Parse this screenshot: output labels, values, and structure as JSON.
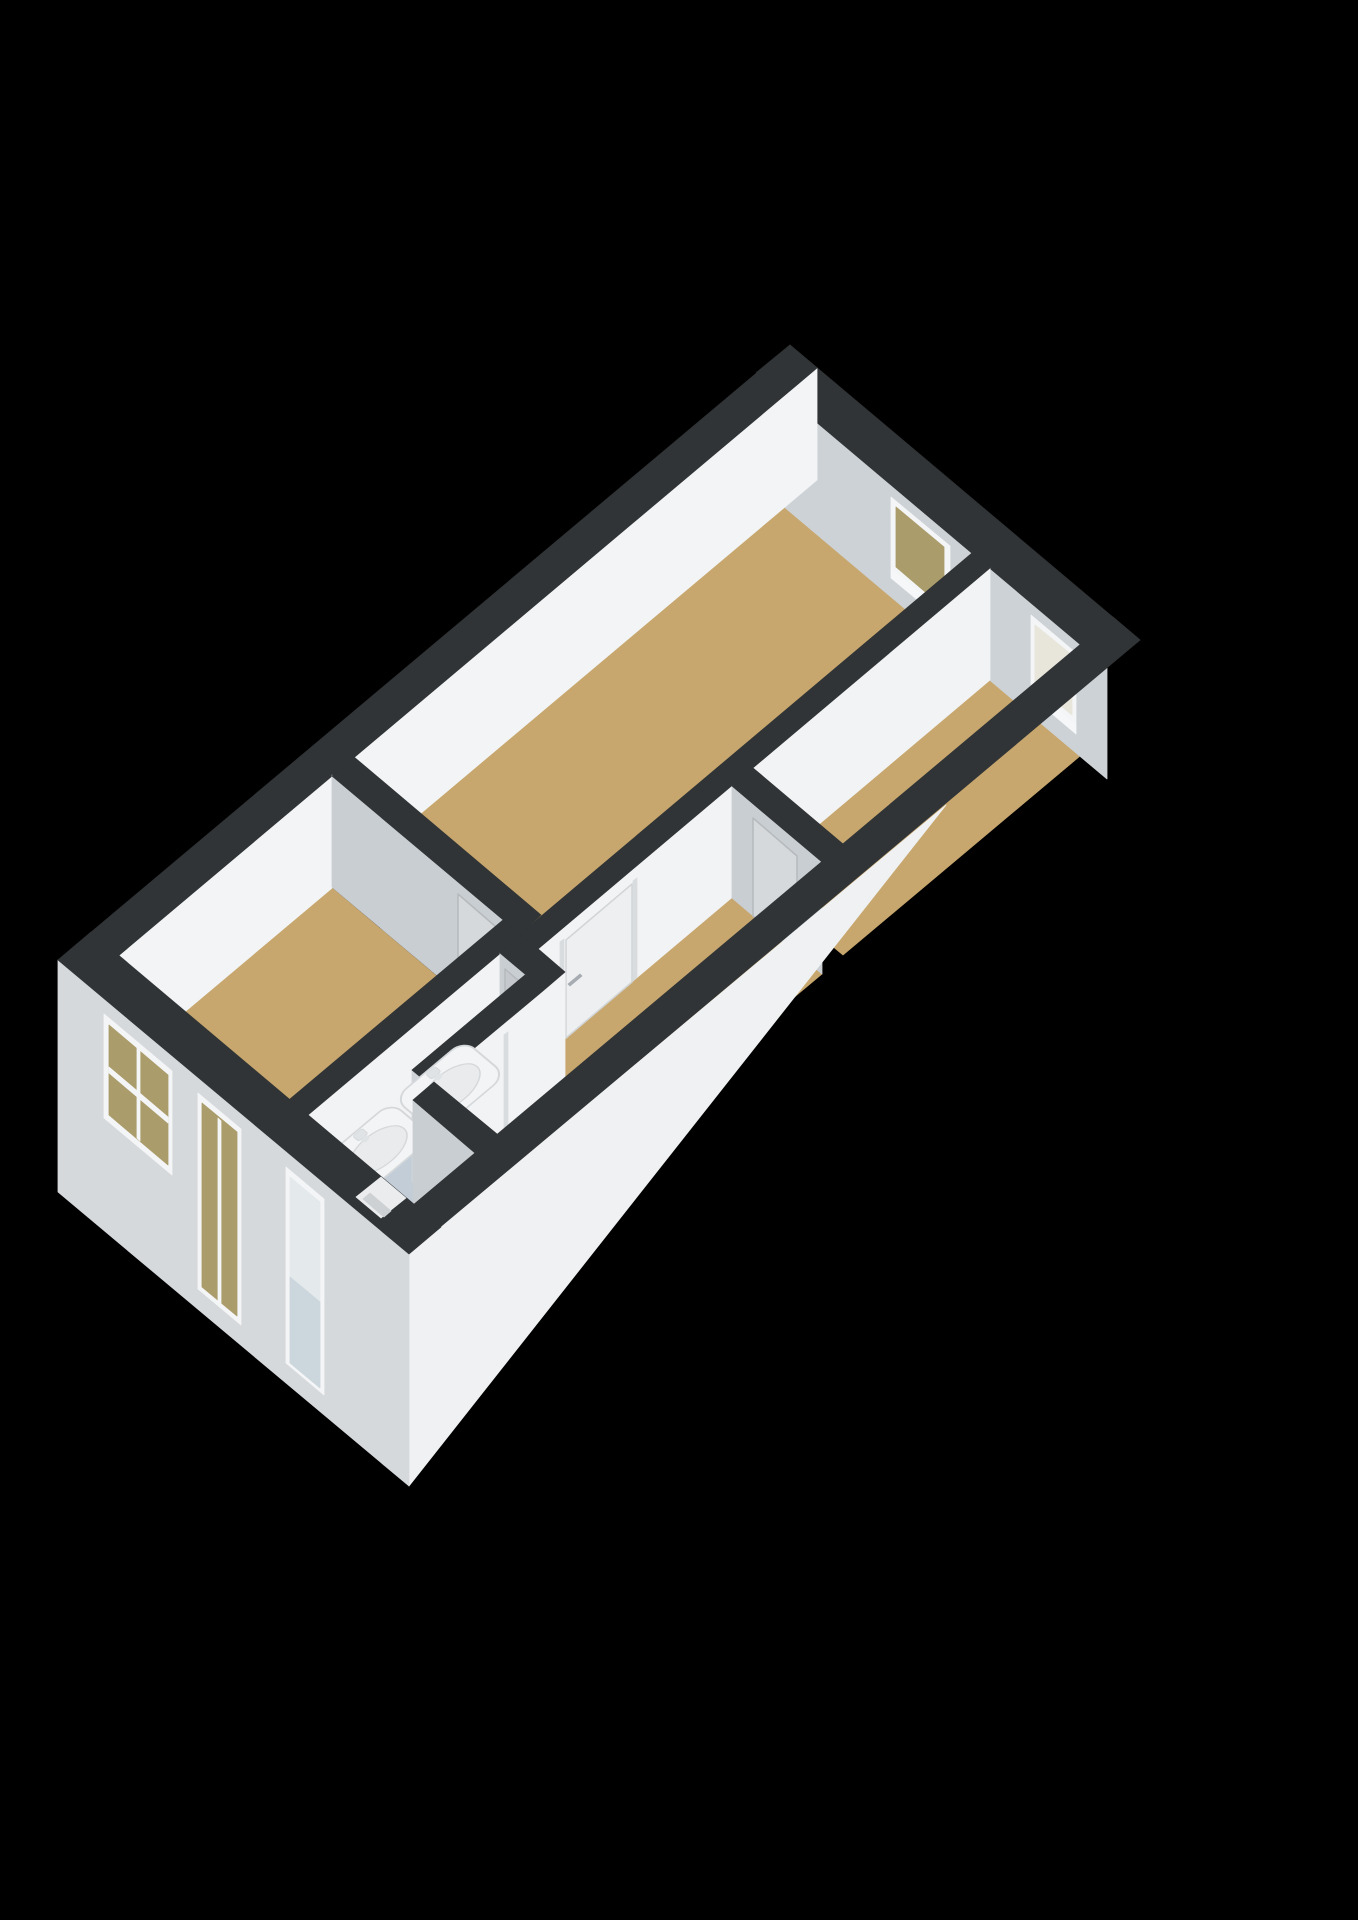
{
  "meta": {
    "title": "3D axonometric floor plan render",
    "background": "#000000",
    "style": "dark wall tops, white walls, wood floors, black background"
  },
  "summary": {
    "rooms": [
      {
        "name": "bedroom-top",
        "floor": "wood-tan"
      },
      {
        "name": "bedroom-right",
        "floor": "wood-tan",
        "features": [
          "window"
        ]
      },
      {
        "name": "bedroom-left",
        "floor": "wood-tan",
        "features": [
          "facade-window",
          "facade-tall-window"
        ]
      },
      {
        "name": "hallway",
        "floor": "wood-tan",
        "features": [
          "doors-to-rooms"
        ]
      },
      {
        "name": "stair-nook",
        "floor": "wood-tan",
        "features": [
          "step-block"
        ]
      },
      {
        "name": "bathroom",
        "floor": "blue-gray",
        "features": [
          "double-washbasin",
          "gray-door",
          "facade-glass-door"
        ]
      }
    ],
    "interior_doors": 4,
    "windows_top_right_wall": 2,
    "openings_bottom_left_facade": 3
  },
  "palette": {
    "band": "#313436",
    "floorTan": "#c7a76e",
    "bathFloor": "#c2cdd8",
    "neFace": "#cdd2d6",
    "nwFace": "#f2f4f5",
    "whiteFace": "#f2f3f4",
    "grayFace": "#c9ced3",
    "capGray": "#d0d4d8",
    "doorWhite": "#edeff0",
    "doorOnGray": "#d5d9dc",
    "doorGrayLeaf": "#c5c9cd",
    "doorEdge": "#d2d5d7",
    "doorEdgeGray": "#b6babd",
    "jamb": "#d9dcde",
    "seam": "#b9bdc0",
    "handleDark": "#a6acb1",
    "handleLight": "#e9ebec",
    "winFrame": "#f4f5f6",
    "winSill": "#f6f7f8",
    "glassTan": "#ab9c6b",
    "glassPale": "#e8e5db",
    "w5Top": "#e4e9ec",
    "w5Bot": "#ccd6dd",
    "facadeSW": "#d6d9dc",
    "facadeSE": "#eff1f2",
    "sinkBody": "#f3f4f5",
    "sinkBowl": "#e9ebed",
    "sinkEdge": "#d5d8da",
    "stepTop": "#eceeef",
    "stepU": "#e0e3e5",
    "stepV": "#cdd1d4",
    "notch": "#ebeced"
  },
  "scene": {
    "viewBox": "0 0 1358 1920",
    "els": [
      {
        "t": "poly",
        "n": "floor-top-room",
        "f": "floorTan",
        "p": "785,507 972,665 541,1027 354,869"
      },
      {
        "t": "poly",
        "n": "floor-right-room",
        "f": "floorTan",
        "p": "990,680 1080,756 843,955 753,880"
      },
      {
        "t": "poly",
        "n": "floor-hallway",
        "f": "floorTan",
        "p": "732,898 822,974 628,1136 538,1061"
      },
      {
        "t": "poly",
        "n": "floor-stair-nook",
        "f": "floorTan",
        "p": "565,1084 628,1136 497,1246 434,1194"
      },
      {
        "t": "poly",
        "n": "floor-left-room",
        "f": "floorTan",
        "p": "332,888 503,1032 290,1211 118,1067"
      },
      {
        "t": "poly",
        "n": "floor-bathroom",
        "f": "bathFloor",
        "p": "500,1065 544,1102 434,1194 497,1246 414,1316 308,1227"
      },
      {
        "t": "poly",
        "n": "ne-wall-face",
        "f": "neFace",
        "p": "757,372 1107,667 1107,779 757,484"
      },
      {
        "t": "poly",
        "n": "window-1-frame",
        "f": "winFrame",
        "p": "891,497 950,546 950,618 891,569"
      },
      {
        "t": "poly",
        "n": "window-1-glass",
        "f": "glassTan",
        "p": "896,507 944,547 944,608 896,567"
      },
      {
        "t": "poly",
        "n": "window-1-sill",
        "f": "winSill",
        "p": "891,569 950,618 950,627 891,578"
      },
      {
        "t": "poly",
        "n": "window-2-frame",
        "f": "winFrame",
        "p": "1031,615 1076,653 1076,725 1031,687"
      },
      {
        "t": "poly",
        "n": "window-2-glass",
        "f": "glassPale",
        "p": "1035,625 1072,655 1072,715 1035,685"
      },
      {
        "t": "poly",
        "n": "window-2-sill",
        "f": "winSill",
        "p": "1031,687 1076,725 1076,734 1031,696"
      },
      {
        "t": "poly",
        "n": "ne-wall-top",
        "f": "band",
        "p": "790,345 1140,640 1107,667 757,372"
      },
      {
        "t": "poly",
        "n": "nw-wall-face",
        "f": "nwFace",
        "p": "817,368 86,983 86,1095 817,480"
      },
      {
        "t": "poly",
        "n": "nw-wall-top",
        "f": "band",
        "p": "790,345 817,368 86,983 58,960"
      },
      {
        "t": "poly",
        "n": "p1-wall-face",
        "f": "whiteFace",
        "p": "990,568 538,949 538,1061 990,680"
      },
      {
        "t": "poly",
        "n": "door-1-jamb-left",
        "f": "jamb",
        "p": "637,878 633,881 633,981 637,977"
      },
      {
        "t": "poly",
        "n": "door-1-jamb-right",
        "f": "jamb",
        "p": "564,939 560,942 560,1042 564,1039"
      },
      {
        "t": "poly",
        "n": "door-1-leaf",
        "f": "doorWhite",
        "s": "doorEdge",
        "sw": 1.5,
        "p": "632,884 566,940 566,1038 632,982"
      },
      {
        "t": "poly",
        "n": "door-1-handle",
        "f": "handleDark",
        "p": "582,976 570,986 568,984 580,974"
      },
      {
        "t": "poly",
        "n": "p1-wall-endcap",
        "f": "capGray",
        "p": "520,933 538,948 538,1061 520,1045"
      },
      {
        "t": "poly",
        "n": "p1-wall-top",
        "f": "band",
        "p": "972,553 990,568 538,949 520,934"
      },
      {
        "t": "poly",
        "n": "p2-wall-face",
        "f": "grayFace",
        "p": "732,786 822,862 822,974 732,898"
      },
      {
        "t": "poly",
        "n": "door-2-leaf",
        "f": "doorOnGray",
        "s": "doorEdgeGray",
        "sw": 1.5,
        "p": "753,818 797,856 797,954 753,916"
      },
      {
        "t": "poly",
        "n": "door-2-handle",
        "f": "handleLight",
        "p": "783,894 795,904 797,902 785,892"
      },
      {
        "t": "poly",
        "n": "p2-wall-top",
        "f": "band",
        "p": "753,768 843,844 822,862 732,786"
      },
      {
        "t": "poly",
        "n": "p3-wall-face",
        "f": "grayFace",
        "p": "332,775 520,933 520,1045 332,887"
      },
      {
        "t": "poly",
        "n": "door-3-leaf",
        "f": "doorOnGray",
        "s": "doorEdgeGray",
        "sw": 1.5,
        "p": "458,894 503,933 503,1031 458,992"
      },
      {
        "t": "poly",
        "n": "door-3-handle",
        "f": "handleLight",
        "p": "490,971 502,981 504,979 492,969"
      },
      {
        "t": "poly",
        "n": "p3-wall-top",
        "f": "band",
        "p": "354,757 541,915 520,934 332,776"
      },
      {
        "t": "poly",
        "n": "sink-wall-face",
        "f": "whiteFace",
        "p": "522,935 308,1115 308,1227 522,1047"
      },
      {
        "t": "poly",
        "n": "sink-wall-top",
        "f": "band",
        "p": "503,920 522,935 308,1115 290,1099"
      },
      {
        "t": "poly",
        "n": "bathroom-wall-face",
        "f": "grayFace",
        "p": "500,953 544,990 544,1102 500,1065"
      },
      {
        "t": "poly",
        "n": "door-4-leaf",
        "f": "doorGrayLeaf",
        "s": "doorEdgeGray",
        "sw": 1.5,
        "p": "505,969 541,1000 541,1100 505,1069"
      },
      {
        "t": "poly",
        "n": "door-4-seam",
        "f": "seam",
        "p": "518,982 520,984 520,1084 518,1082"
      },
      {
        "t": "poly",
        "n": "door-4-handle",
        "f": "handleLight",
        "p": "504,1019 516,1029 518,1027 506,1017"
      },
      {
        "t": "poly",
        "n": "bathroom-wall-endcap",
        "f": "whiteFace",
        "p": "565,972 544,990 544,1102 565,1084"
      },
      {
        "t": "poly",
        "n": "bathroom-wall-top",
        "f": "band",
        "p": "522,935 565,972 544,990 500,953"
      },
      {
        "t": "poly",
        "n": "nook-wall-face",
        "f": "whiteFace",
        "p": "544,990 430,1085 430,1197 544,1102"
      },
      {
        "t": "poly",
        "n": "nook-wall-jamb-a",
        "f": "jamb",
        "p": "508,1032 504,1035 504,1135 508,1132"
      },
      {
        "t": "poly",
        "n": "nook-wall-jamb-b",
        "f": "jamb",
        "p": "461,1071 457,1074 457,1174 461,1171"
      },
      {
        "t": "poly",
        "n": "nook-wall-endcap",
        "f": "capGray",
        "p": "412,1070 430,1085 430,1197 412,1182"
      },
      {
        "t": "poly",
        "n": "nook-wall-top",
        "f": "band",
        "p": "525,975 544,990 430,1085 412,1070"
      },
      {
        "t": "rect",
        "n": "sink-1-basin",
        "tr": "matrix(-0.775,0.651,0.651,0.548,464,1040)",
        "x": 0,
        "y": 0,
        "w": 90,
        "h": 64,
        "rx": 16,
        "f": "sinkBody",
        "s": "sinkEdge",
        "sw": 2
      },
      {
        "t": "ellipse",
        "n": "sink-1-bowl",
        "tr": "matrix(-0.775,0.651,0.651,0.548,464,1040)",
        "cx": 45,
        "cy": 34,
        "rx": 33,
        "ry": 20,
        "f": "sinkBowl",
        "s": "sinkEdge",
        "sw": 1.5
      },
      {
        "t": "rect",
        "n": "sink-1-faucet",
        "tr": "matrix(-0.775,0.651,0.651,0.548,464,1040)",
        "x": 39,
        "y": 2,
        "w": 12,
        "h": 9,
        "rx": 2,
        "f": "stepU",
        "s": "sinkEdge",
        "sw": 1
      },
      {
        "t": "ellipse",
        "n": "sink-1-spout",
        "tr": "matrix(-0.775,0.651,0.651,0.548,464,1040)",
        "cx": 45,
        "cy": 14,
        "rx": 4,
        "ry": 3,
        "f": "stepU"
      },
      {
        "t": "rect",
        "n": "sink-2-basin",
        "tr": "matrix(-0.775,0.651,0.651,0.548,391,1102)",
        "x": 0,
        "y": 0,
        "w": 90,
        "h": 64,
        "rx": 16,
        "f": "sinkBody",
        "s": "sinkEdge",
        "sw": 2
      },
      {
        "t": "ellipse",
        "n": "sink-2-bowl",
        "tr": "matrix(-0.775,0.651,0.651,0.548,391,1102)",
        "cx": 45,
        "cy": 34,
        "rx": 33,
        "ry": 20,
        "f": "sinkBowl",
        "s": "sinkEdge",
        "sw": 1.5
      },
      {
        "t": "rect",
        "n": "sink-2-faucet",
        "tr": "matrix(-0.775,0.651,0.651,0.548,391,1102)",
        "x": 39,
        "y": 2,
        "w": 12,
        "h": 9,
        "rx": 2,
        "f": "stepU",
        "s": "sinkEdge",
        "sw": 1
      },
      {
        "t": "ellipse",
        "n": "sink-2-spout",
        "tr": "matrix(-0.775,0.651,0.651,0.548,391,1102)",
        "cx": 45,
        "cy": 14,
        "rx": 4,
        "ry": 3,
        "f": "stepU"
      },
      {
        "t": "poly",
        "n": "step-block-front",
        "f": "stepU",
        "p": "559,1168 497,1220 497,1246 559,1194"
      },
      {
        "t": "poly",
        "n": "step-block-side",
        "f": "stepV",
        "p": "461,1190 497,1220 497,1246 461,1216"
      },
      {
        "t": "poly",
        "n": "step-block-top",
        "f": "stepTop",
        "p": "522,1138 559,1168 497,1220 461,1190"
      },
      {
        "t": "poly",
        "n": "p7-wall-face",
        "f": "grayFace",
        "p": "413,1100 475,1153 475,1265 413,1212"
      },
      {
        "t": "poly",
        "n": "p7-wall-top",
        "f": "band",
        "p": "434,1082 497,1134 475,1153 413,1100"
      },
      {
        "t": "poly",
        "n": "se-wall-top",
        "f": "band",
        "p": "1113,617 1140,640 409,1254 381,1232"
      },
      {
        "t": "poly",
        "n": "se-facade",
        "f": "facadeSE",
        "p": "409,1254 946,805 409,1486"
      },
      {
        "t": "poly",
        "n": "sw-facade",
        "f": "facadeSW",
        "p": "58,960 409,1254 409,1486 58,1192"
      },
      {
        "t": "poly",
        "n": "window-3-frame",
        "f": "winFrame",
        "p": "104,1014 172,1071 172,1175 104,1118"
      },
      {
        "t": "poly",
        "n": "window-3-glass",
        "f": "glassTan",
        "p": "109,1025 168,1075 168,1165 109,1115"
      },
      {
        "t": "poly",
        "n": "window-3-mullion-v",
        "f": "winFrame",
        "p": "137,1048 140,1051 140,1141 137,1138"
      },
      {
        "t": "poly",
        "n": "window-3-mullion-h",
        "f": "winFrame",
        "p": "109,1067 168,1117 168,1123 109,1073"
      },
      {
        "t": "poly",
        "n": "window-4-frame",
        "f": "winFrame",
        "p": "198,1093 241,1129 241,1325 198,1289"
      },
      {
        "t": "poly",
        "n": "window-4-glass",
        "f": "glassTan",
        "p": "202,1103 237,1132 237,1316 202,1287"
      },
      {
        "t": "poly",
        "n": "window-4-mullion",
        "f": "winFrame",
        "p": "218,1118 221,1121 221,1305 218,1302"
      },
      {
        "t": "poly",
        "n": "glass-door-frame",
        "f": "winFrame",
        "p": "286,1167 324,1199 324,1395 286,1363"
      },
      {
        "t": "poly",
        "n": "glass-door-upper",
        "f": "w5Top",
        "p": "290,1177 320,1202 320,1302 290,1277"
      },
      {
        "t": "poly",
        "n": "glass-door-lower",
        "f": "w5Bot",
        "p": "290,1277 320,1302 320,1388 290,1363"
      },
      {
        "t": "poly",
        "n": "sw-wall-top",
        "f": "band",
        "p": "91,932 441,1227 409,1254 58,960"
      },
      {
        "t": "poly",
        "n": "sw-door-notch",
        "f": "notch",
        "p": "381,1177 406,1198 381,1218 356,1197"
      },
      {
        "t": "poly",
        "n": "sw-door-notch-step",
        "f": "stepV",
        "p": "370,1193 391,1211 384,1217 363,1199"
      }
    ]
  }
}
